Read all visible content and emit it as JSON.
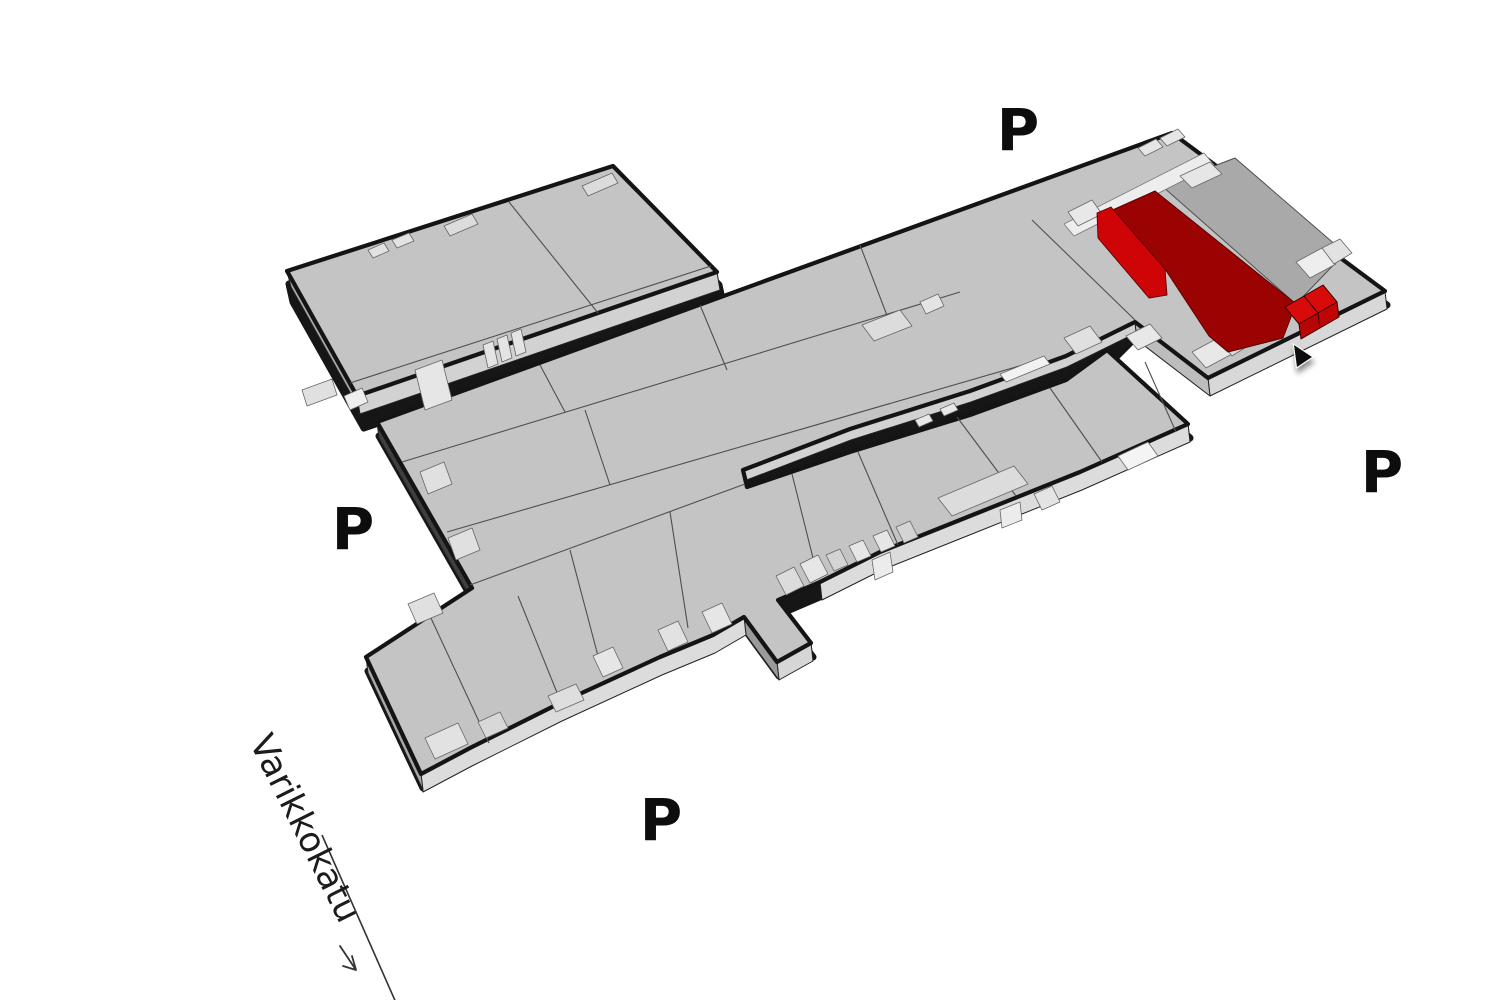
{
  "map": {
    "kind": "isometric-site-plan",
    "highlight_present": true
  },
  "parking_labels": [
    {
      "id": "north",
      "text": "P"
    },
    {
      "id": "east",
      "text": "P"
    },
    {
      "id": "west",
      "text": "P"
    },
    {
      "id": "south",
      "text": "P"
    }
  ],
  "street": {
    "name": "Varikkokatu"
  },
  "colors": {
    "background": "#ffffff",
    "building_roof": "#c4c4c4",
    "building_outline": "#141414",
    "wall_light": "#dcdcdc",
    "wall_mid": "#bdbdbd",
    "wall_dark": "#3f3f3f",
    "door_light": "#e6e6e6",
    "adjacent_unit_gray": "#a9a9a9",
    "highlighted_unit_dark": "#9b0303",
    "highlighted_unit_bright": "#ce0406",
    "highlighted_box_top": "#d80a0a",
    "highlighted_box_front": "#b80404"
  }
}
